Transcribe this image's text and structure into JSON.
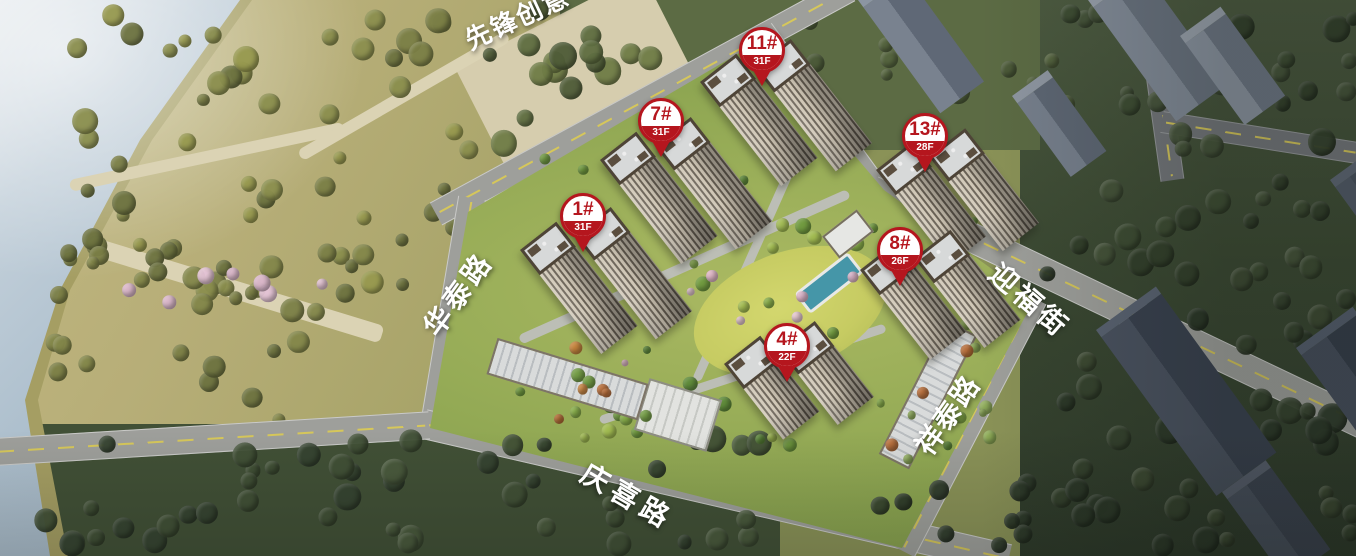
{
  "map": {
    "description": "aerial-rendering-of-residential-development-with-building-pins",
    "pins": [
      {
        "id": "1#",
        "floors": "31F"
      },
      {
        "id": "4#",
        "floors": "22F"
      },
      {
        "id": "7#",
        "floors": "31F"
      },
      {
        "id": "8#",
        "floors": "26F"
      },
      {
        "id": "11#",
        "floors": "31F"
      },
      {
        "id": "13#",
        "floors": "28F"
      }
    ],
    "roads": [
      {
        "name": "先锋创意"
      },
      {
        "name": "华泰路"
      },
      {
        "name": "迎福街"
      },
      {
        "name": "祥泰路"
      },
      {
        "name": "庆喜路"
      }
    ],
    "colors": {
      "pin_red": "#b5161e",
      "water": "#adbfcd",
      "park_ground": "#b7ae78",
      "lawn": "#c6cb62",
      "pool": "#4596a8",
      "road": "#9e9f9b",
      "context_building": "#39414f"
    }
  }
}
